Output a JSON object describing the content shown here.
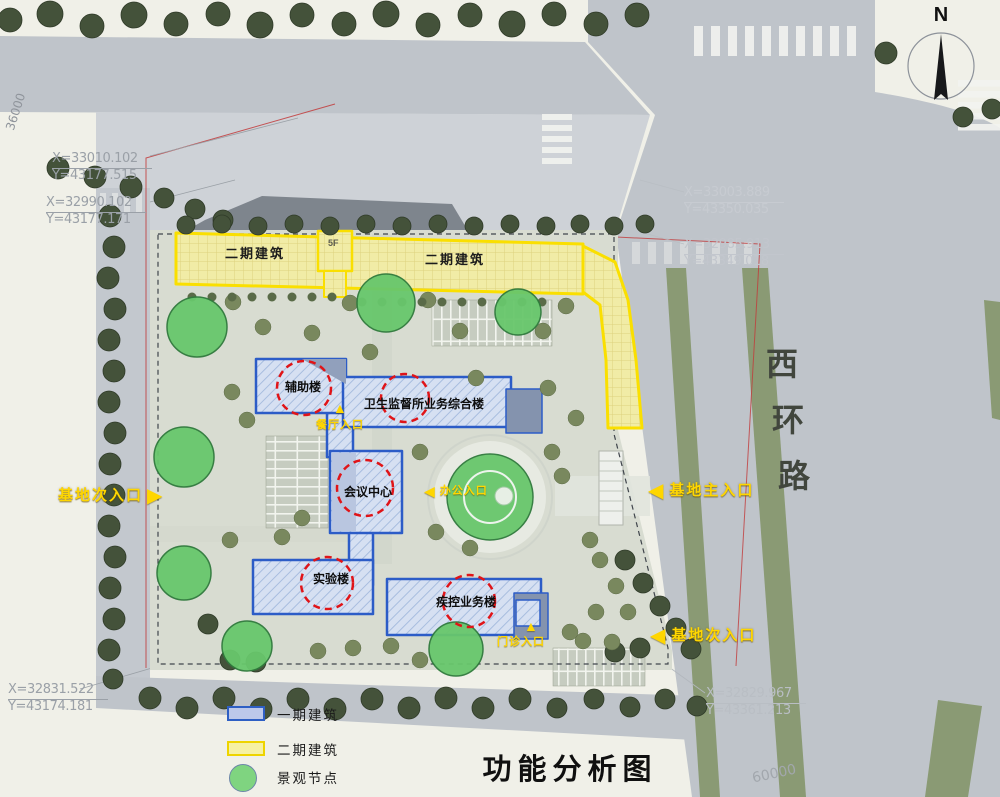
{
  "title": "功能分析图",
  "compass": {
    "label": "N"
  },
  "road": {
    "name": "西环路",
    "chars": [
      "西",
      "环",
      "路"
    ]
  },
  "dims": {
    "left_edge": "36000",
    "bottom_right": "60000"
  },
  "coords": {
    "tl1": {
      "x": "X=33010.102",
      "y": "Y=43177.515"
    },
    "tl2": {
      "x": "X=32990.102",
      "y": "Y=43177.171"
    },
    "tm1": {
      "x": "X=33003.889",
      "y": "Y=43350.035"
    },
    "tm2": {
      "x": "X=32985.913",
      "y": "Y=43349.018"
    },
    "bl": {
      "x": "X=32831.522",
      "y": "Y=43174.181"
    },
    "br": {
      "x": "X=32829.967",
      "y": "Y=43361.213"
    }
  },
  "buildings": {
    "phase2_left": "二期建筑",
    "phase2_right": "二期建筑",
    "floors": "5F",
    "auxiliary": "辅助楼",
    "comprehensive": "卫生监督所业务综合楼",
    "conference": "会议中心",
    "laboratory": "实验楼",
    "cdc": "疾控业务楼"
  },
  "entrances": {
    "west_secondary": "基地次入口",
    "east_main": "基地主入口",
    "east_secondary": "基地次入口",
    "canteen": "餐厅入口",
    "office": "办公入口",
    "clinic": "门诊入口"
  },
  "icons": {
    "arrow_left": "◀",
    "arrow_right": "▶",
    "arrow_up": "▲"
  },
  "legend": {
    "items": [
      {
        "label": "一期建筑",
        "swatch": "phase1",
        "fill": "#bcc8ea",
        "border": "#2e5fc4"
      },
      {
        "label": "二期建筑",
        "swatch": "phase2",
        "fill": "#f6f1a4",
        "border": "#eed400"
      },
      {
        "label": "景观节点",
        "swatch": "node",
        "fill": "#7fd480",
        "border": "#6c86a8"
      }
    ]
  },
  "colors": {
    "phase1_outline": "#2c5cc7",
    "phase2_outline": "#fadf00",
    "node_green": "#68c76c",
    "red_circle": "#e01418",
    "entrance_yellow": "#ffd600",
    "road_gray": "#bfc4ca",
    "median_green": "#8a9a74"
  }
}
